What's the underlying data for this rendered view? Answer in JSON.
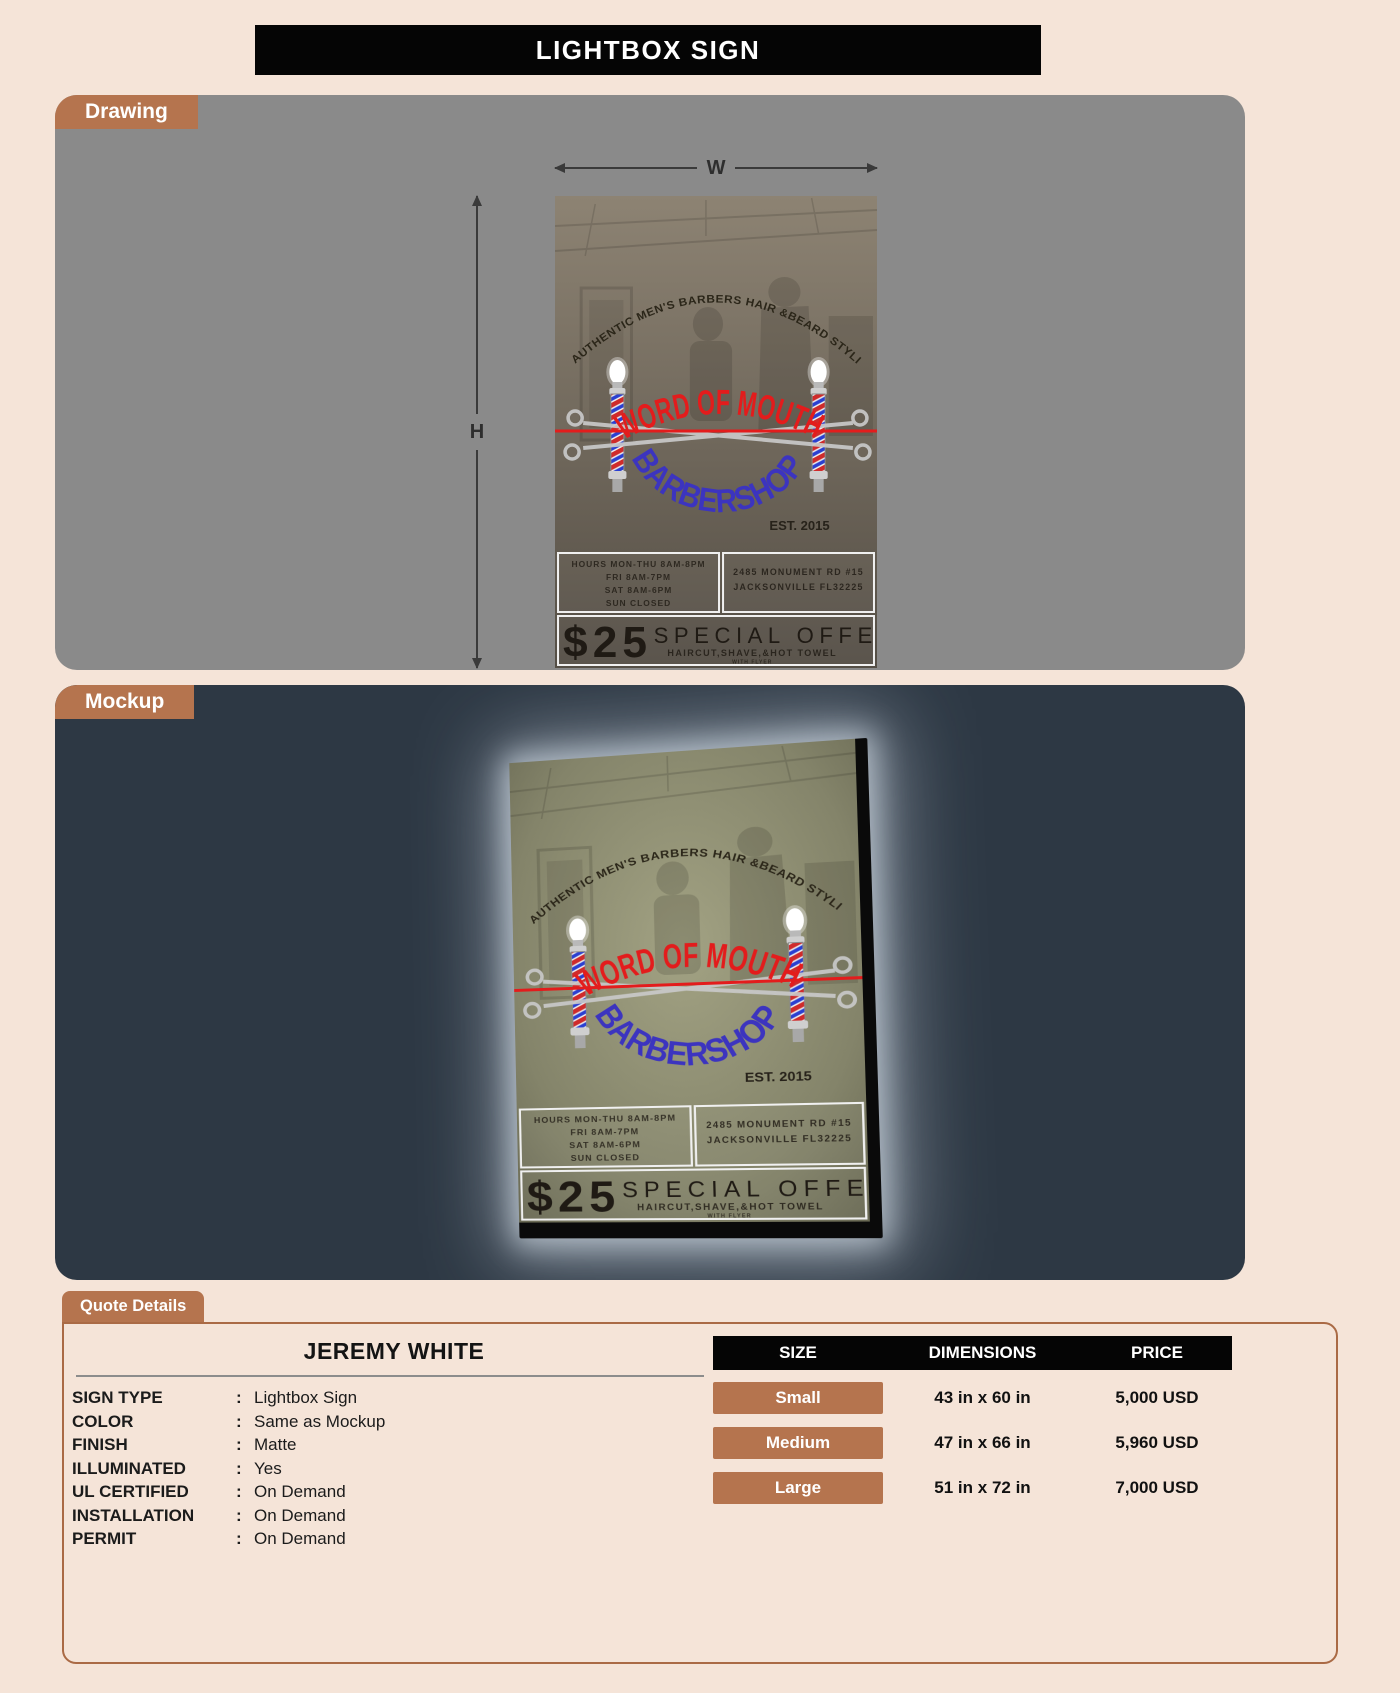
{
  "title": "LIGHTBOX SIGN",
  "sections": {
    "drawing": "Drawing",
    "mockup": "Mockup",
    "quote": "Quote Details"
  },
  "dimension_labels": {
    "width": "W",
    "height": "H"
  },
  "sign": {
    "arch_text": "AUTHENTIC MEN'S BARBERS HAIR &BEARD STYLING",
    "name_top": "WORD OF MOUTH",
    "name_bottom": "BARBERSHOP",
    "established": "EST. 2015",
    "hours": [
      "HOURS MON-THU 8AM-8PM",
      "FRI 8AM-7PM",
      "SAT 8AM-6PM",
      "SUN CLOSED"
    ],
    "address": [
      "2485 MONUMENT RD #15",
      "JACKSONVILLE FL32225"
    ],
    "offer_price": "$25",
    "offer_title": "SPECIAL OFFER",
    "offer_subtitle": "HAIRCUT,SHAVE,&HOT TOWEL",
    "offer_note": "WITH FLYER"
  },
  "quote": {
    "customer_name": "JEREMY WHITE",
    "colon": ":",
    "specs": [
      {
        "label": "SIGN TYPE",
        "value": "Lightbox Sign"
      },
      {
        "label": "COLOR",
        "value": "Same as Mockup"
      },
      {
        "label": "FINISH",
        "value": "Matte"
      },
      {
        "label": "ILLUMINATED",
        "value": "Yes"
      },
      {
        "label": "UL CERTIFIED",
        "value": "On Demand"
      },
      {
        "label": "INSTALLATION",
        "value": "On Demand"
      },
      {
        "label": "PERMIT",
        "value": "On Demand"
      }
    ],
    "pricing": {
      "headers": [
        "SIZE",
        "DIMENSIONS",
        "PRICE"
      ],
      "rows": [
        {
          "size": "Small",
          "dimensions": "43 in x 60 in",
          "price": "5,000 USD"
        },
        {
          "size": "Medium",
          "dimensions": "47 in x 66 in",
          "price": "5,960 USD"
        },
        {
          "size": "Large",
          "dimensions": "51 in x 72 in",
          "price": "7,000 USD"
        }
      ]
    }
  },
  "colors": {
    "accent": "#b5744e",
    "page_bg": "#f5e4d8",
    "drawing_bg": "#8a8a8a",
    "mockup_bg": "#2d3844",
    "sign_red": "#e31c1c",
    "sign_blue": "#3c34bf",
    "table_header_bg": "#050505",
    "panel_border": "#aa6a45"
  }
}
